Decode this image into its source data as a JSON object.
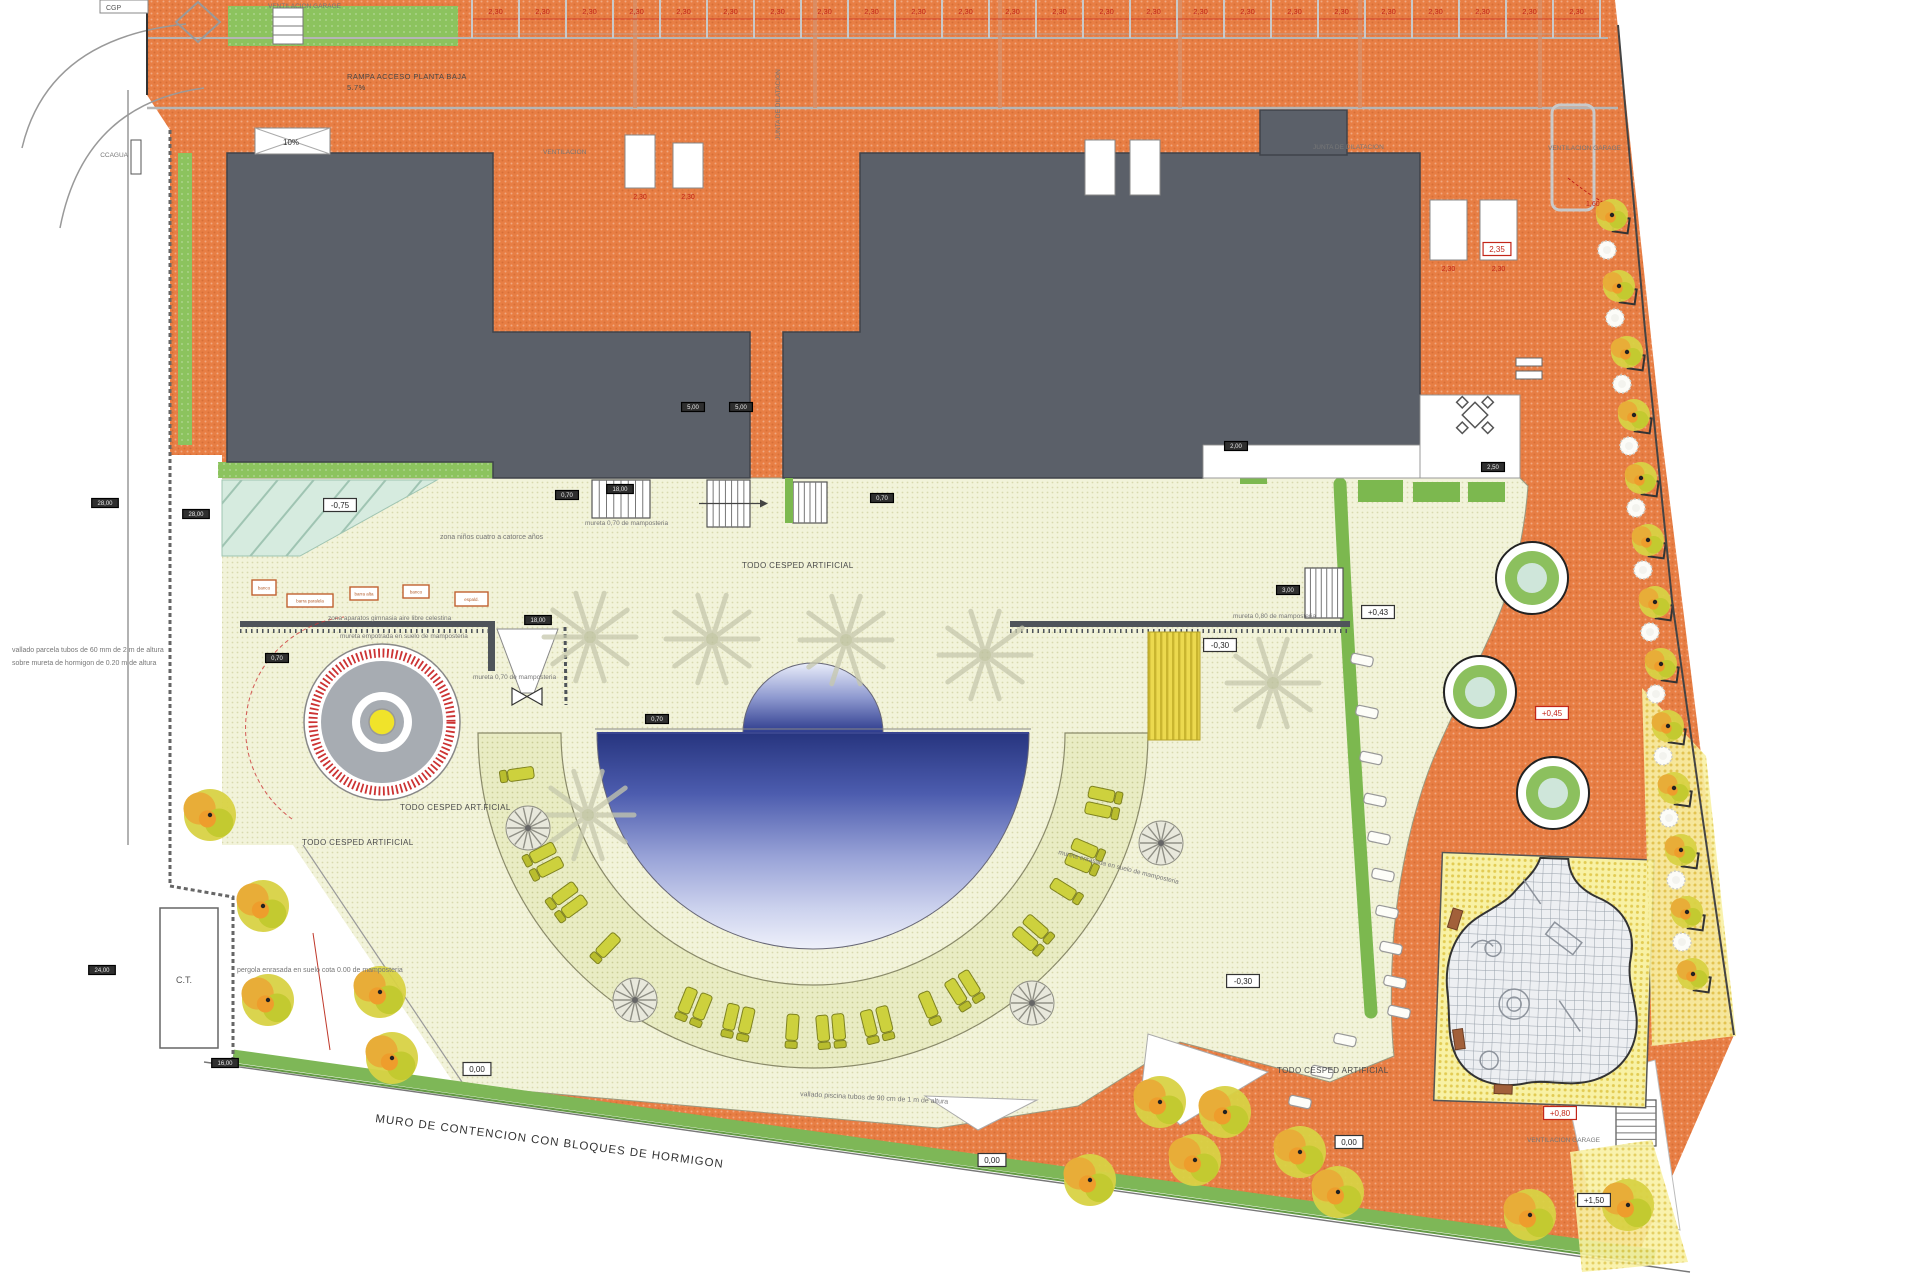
{
  "labels": {
    "cgp": "CGP",
    "ccagua": "CCAGUA",
    "vent_garage_tl": "VENTILACION GARAGE",
    "rampa": "RAMPA ACCESO PLANTA BAJA",
    "rampa_pct": "5.7%",
    "pct10": "10%",
    "ventilacion": "VENTILACION",
    "junta_v": "JUNTA DE DILATACION",
    "junta_h": "JUNTA DE DILATACION",
    "vent_garage_tr": "VENTILACION GARAGE",
    "vent_garage_br": "VENTILACION GARAGE",
    "zona_ninos": "zona niños cuatro a catorce años",
    "todo1": "TODO CESPED ARTIFICIAL",
    "todo2": "TODO CESPED ART.FICIAL",
    "todo3": "TODO CESPED ARTIFICIAL",
    "todo4": "TODO CESPED ARTIFICIAL",
    "mureta070a": "mureta 0,70 de mamposteria",
    "mureta070b": "mureta 0,70 de mamposteria",
    "mureta080": "mureta 0,80 de mamposteria",
    "zona_aparatos": "zona aparatos gimnasia aire libre celestina",
    "mureta_empotrada": "mureta empotrada en suelo de mamposteria",
    "mureta_enrasada": "mureta enrasada en suelo de mamposteria",
    "vallado_piscina": "vallado piscina tubos de 90 cm de 1 m de altura",
    "pergola": "pergola enrasada en suelo cota 0.00 de mamposteria",
    "vallado1": "vallado parcela tubos de 60 mm de 2 m de altura",
    "vallado2": "sobre mureta de hormigon de 0.20 m de altura",
    "muro": "MURO DE CONTENCION  CON BLOQUES DE HORMIGON",
    "ct": "C.T."
  },
  "dims": {
    "bay_label": "2,30",
    "vent_label": "2,30",
    "dim160": "1,60"
  },
  "tags": {
    "white": [
      [
        340,
        505,
        "-0,75"
      ],
      [
        1220,
        645,
        "-0,30"
      ],
      [
        1243,
        981,
        "-0,30"
      ],
      [
        1378,
        612,
        "+0,43"
      ],
      [
        477,
        1069,
        "0,00"
      ],
      [
        1349,
        1142,
        "0,00"
      ],
      [
        992,
        1160,
        "0,00"
      ],
      [
        1594,
        1200,
        "+1,50"
      ]
    ],
    "red": [
      [
        1552,
        713,
        "+0,45"
      ],
      [
        1560,
        1113,
        "+0,80"
      ],
      [
        1497,
        249,
        "2,35"
      ]
    ],
    "dark": [
      [
        105,
        503,
        "28,00"
      ],
      [
        196,
        514,
        "28,00"
      ],
      [
        102,
        970,
        "24,00"
      ],
      [
        225,
        1063,
        "16,00"
      ],
      [
        538,
        620,
        "18,00"
      ],
      [
        277,
        658,
        "0,70"
      ],
      [
        567,
        495,
        "0,70"
      ],
      [
        620,
        489,
        "18,00"
      ],
      [
        882,
        498,
        "0,70"
      ],
      [
        693,
        407,
        "5,00"
      ],
      [
        741,
        407,
        "5,00"
      ],
      [
        657,
        719,
        "0,70"
      ],
      [
        1288,
        590,
        "3,00"
      ],
      [
        1236,
        446,
        "2,00"
      ],
      [
        1493,
        467,
        "2,50"
      ]
    ]
  },
  "gym_boxes": [
    {
      "x": 252,
      "y": 580,
      "w": 24,
      "h": 15,
      "label": "banco"
    },
    {
      "x": 287,
      "y": 594,
      "w": 46,
      "h": 13,
      "label": "barra paralela"
    },
    {
      "x": 350,
      "y": 587,
      "w": 28,
      "h": 13,
      "label": "barra alta"
    },
    {
      "x": 403,
      "y": 585,
      "w": 26,
      "h": 13,
      "label": "banco"
    },
    {
      "x": 455,
      "y": 592,
      "w": 33,
      "h": 14,
      "label": "espald."
    }
  ],
  "features": {
    "parking": {
      "x0": 472,
      "step": 47,
      "count": 24
    },
    "vents": [
      [
        625,
        135,
        30,
        53
      ],
      [
        673,
        143,
        30,
        45
      ],
      [
        1085,
        140,
        30,
        55
      ],
      [
        1130,
        140,
        30,
        55
      ],
      [
        1430,
        200,
        37,
        60
      ],
      [
        1480,
        200,
        37,
        60
      ]
    ],
    "trees_big": [
      [
        210,
        815
      ],
      [
        263,
        906
      ],
      [
        268,
        1000
      ],
      [
        380,
        992
      ],
      [
        392,
        1058
      ],
      [
        1160,
        1102
      ],
      [
        1225,
        1112
      ],
      [
        1090,
        1180
      ],
      [
        1195,
        1160
      ],
      [
        1300,
        1152
      ],
      [
        1338,
        1192
      ],
      [
        1530,
        1215
      ],
      [
        1628,
        1205
      ]
    ],
    "trees_right": [
      [
        1612,
        215
      ],
      [
        1619,
        286
      ],
      [
        1627,
        352
      ],
      [
        1634,
        415
      ],
      [
        1641,
        478
      ],
      [
        1648,
        540
      ],
      [
        1655,
        602
      ],
      [
        1661,
        664
      ],
      [
        1668,
        726
      ],
      [
        1674,
        788
      ],
      [
        1681,
        850
      ],
      [
        1687,
        912
      ],
      [
        1693,
        974
      ]
    ],
    "shrubs": [
      [
        1607,
        250
      ],
      [
        1615,
        318
      ],
      [
        1622,
        384
      ],
      [
        1629,
        446
      ],
      [
        1636,
        508
      ],
      [
        1643,
        570
      ],
      [
        1650,
        632
      ],
      [
        1656,
        694
      ],
      [
        1663,
        756
      ],
      [
        1669,
        818
      ],
      [
        1676,
        880
      ],
      [
        1682,
        942
      ]
    ],
    "palms": [
      [
        590,
        637
      ],
      [
        712,
        639
      ],
      [
        846,
        640
      ],
      [
        985,
        655
      ],
      [
        1273,
        683
      ],
      [
        588,
        815
      ]
    ],
    "umbrellas": [
      [
        528,
        828
      ],
      [
        635,
        1000
      ],
      [
        1032,
        1003
      ],
      [
        1161,
        843
      ]
    ],
    "lounger_angles": [
      172,
      153,
      144,
      134,
      112,
      103,
      94,
      85,
      76,
      67,
      58,
      41,
      32,
      23,
      12
    ],
    "stones": [
      [
        1362,
        660
      ],
      [
        1367,
        712
      ],
      [
        1371,
        758
      ],
      [
        1375,
        800
      ],
      [
        1379,
        838
      ],
      [
        1383,
        875
      ],
      [
        1387,
        912
      ],
      [
        1391,
        948
      ],
      [
        1395,
        982
      ],
      [
        1399,
        1012
      ],
      [
        1345,
        1040
      ],
      [
        1322,
        1072
      ],
      [
        1300,
        1102
      ]
    ],
    "planters": [
      [
        1532,
        578
      ],
      [
        1480,
        692
      ],
      [
        1553,
        793
      ]
    ]
  },
  "colors": {
    "paving_orange": "#e87e44",
    "deck_cream": "#f2f3da",
    "lounge_band": "#e9ecc4",
    "building_gray": "#5b6069",
    "grass_green": "#8cc35e",
    "hedge_green": "#7cb84f",
    "pool_dark": "#27357f",
    "pool_light": "#eef0fa",
    "play_yellow": "#f8f1a4",
    "dim_red": "#c22619"
  }
}
